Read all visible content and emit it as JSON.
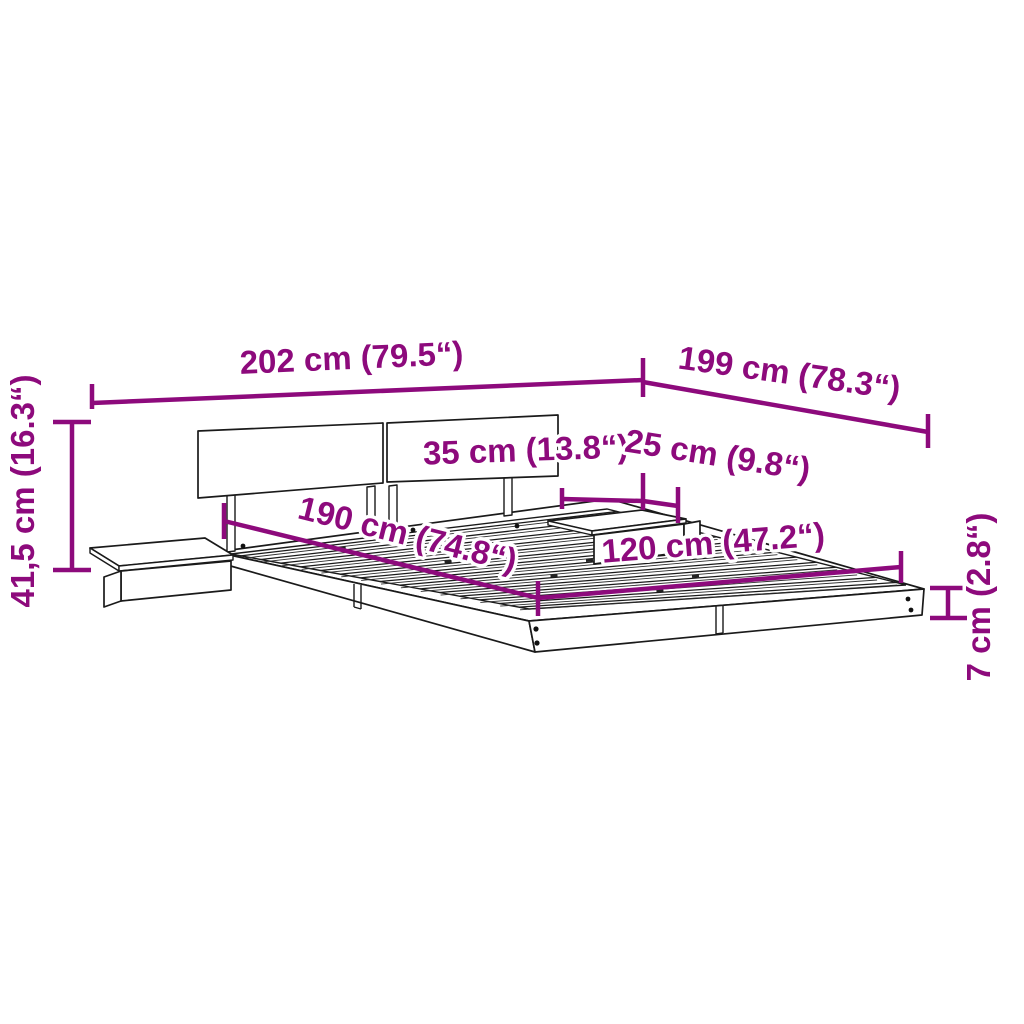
{
  "diagram": {
    "kind": "product-dimension-diagram",
    "subject": "wall-style bed frame with headboard, slatted base and two floating bedside shelves",
    "background_color": "#ffffff",
    "line_color": "#1a1a1a",
    "accent_color": "#8d0a7c",
    "unit_system": "cm with inches in parentheses",
    "dimensions": [
      {
        "id": "total-width",
        "label": "202 cm (79.5“)"
      },
      {
        "id": "total-depth",
        "label": "199 cm (78.3“)"
      },
      {
        "id": "headboard-height",
        "label": "41,5 cm (16.3“)"
      },
      {
        "id": "shelf-width",
        "label": "35 cm (13.8“)"
      },
      {
        "id": "shelf-depth",
        "label": "25 cm (9.8“)"
      },
      {
        "id": "bed-length",
        "label": "190 cm (74.8“)"
      },
      {
        "id": "bed-width",
        "label": "120 cm (47.2“)"
      },
      {
        "id": "frame-height",
        "label": "7 cm (2.8“)"
      }
    ]
  }
}
